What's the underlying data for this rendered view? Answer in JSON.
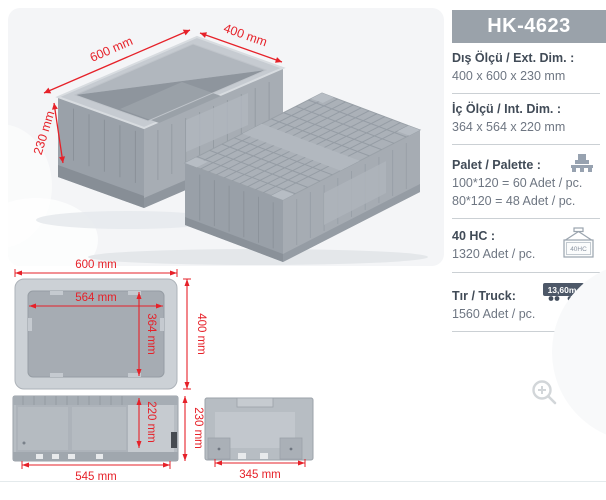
{
  "product_code": "HK-4623",
  "specs": {
    "ext": {
      "label": "Dış Ölçü / Ext. Dim. :",
      "value": "400 x 600 x 230 mm"
    },
    "int": {
      "label": "İç Ölçü / Int. Dim.  :",
      "value": "364 x 564 x 220 mm"
    },
    "pallet": {
      "label": "Palet / Palette :",
      "line1": "100*120 = 60 Adet / pc.",
      "line2": "80*120 = 48 Adet / pc."
    },
    "hc40": {
      "label": "40 HC :",
      "value": "1320 Adet / pc.",
      "icon_text": "40HC"
    },
    "truck": {
      "label": "Tır / Truck:",
      "value": "1560 Adet / pc.",
      "icon_text": "13,60m"
    }
  },
  "hero_dimensions": {
    "length": "600 mm",
    "width": "400 mm",
    "height": "230 mm"
  },
  "drawings": {
    "top_view": {
      "outer_width": "600 mm",
      "inner_width": "564 mm",
      "inner_depth": "364 mm",
      "outer_depth": "400 mm"
    },
    "long_side_view": {
      "inner_height": "220 mm",
      "outer_height": "230 mm",
      "bottom_width": "545 mm"
    },
    "short_side_view": {
      "bottom_width": "345 mm"
    }
  },
  "colors": {
    "dimension_red": "#e62129",
    "header_bg": "#9aa2aa",
    "crate_gray": "#a9afb6",
    "label_text": "#414b57",
    "value_text": "#6e7682"
  }
}
